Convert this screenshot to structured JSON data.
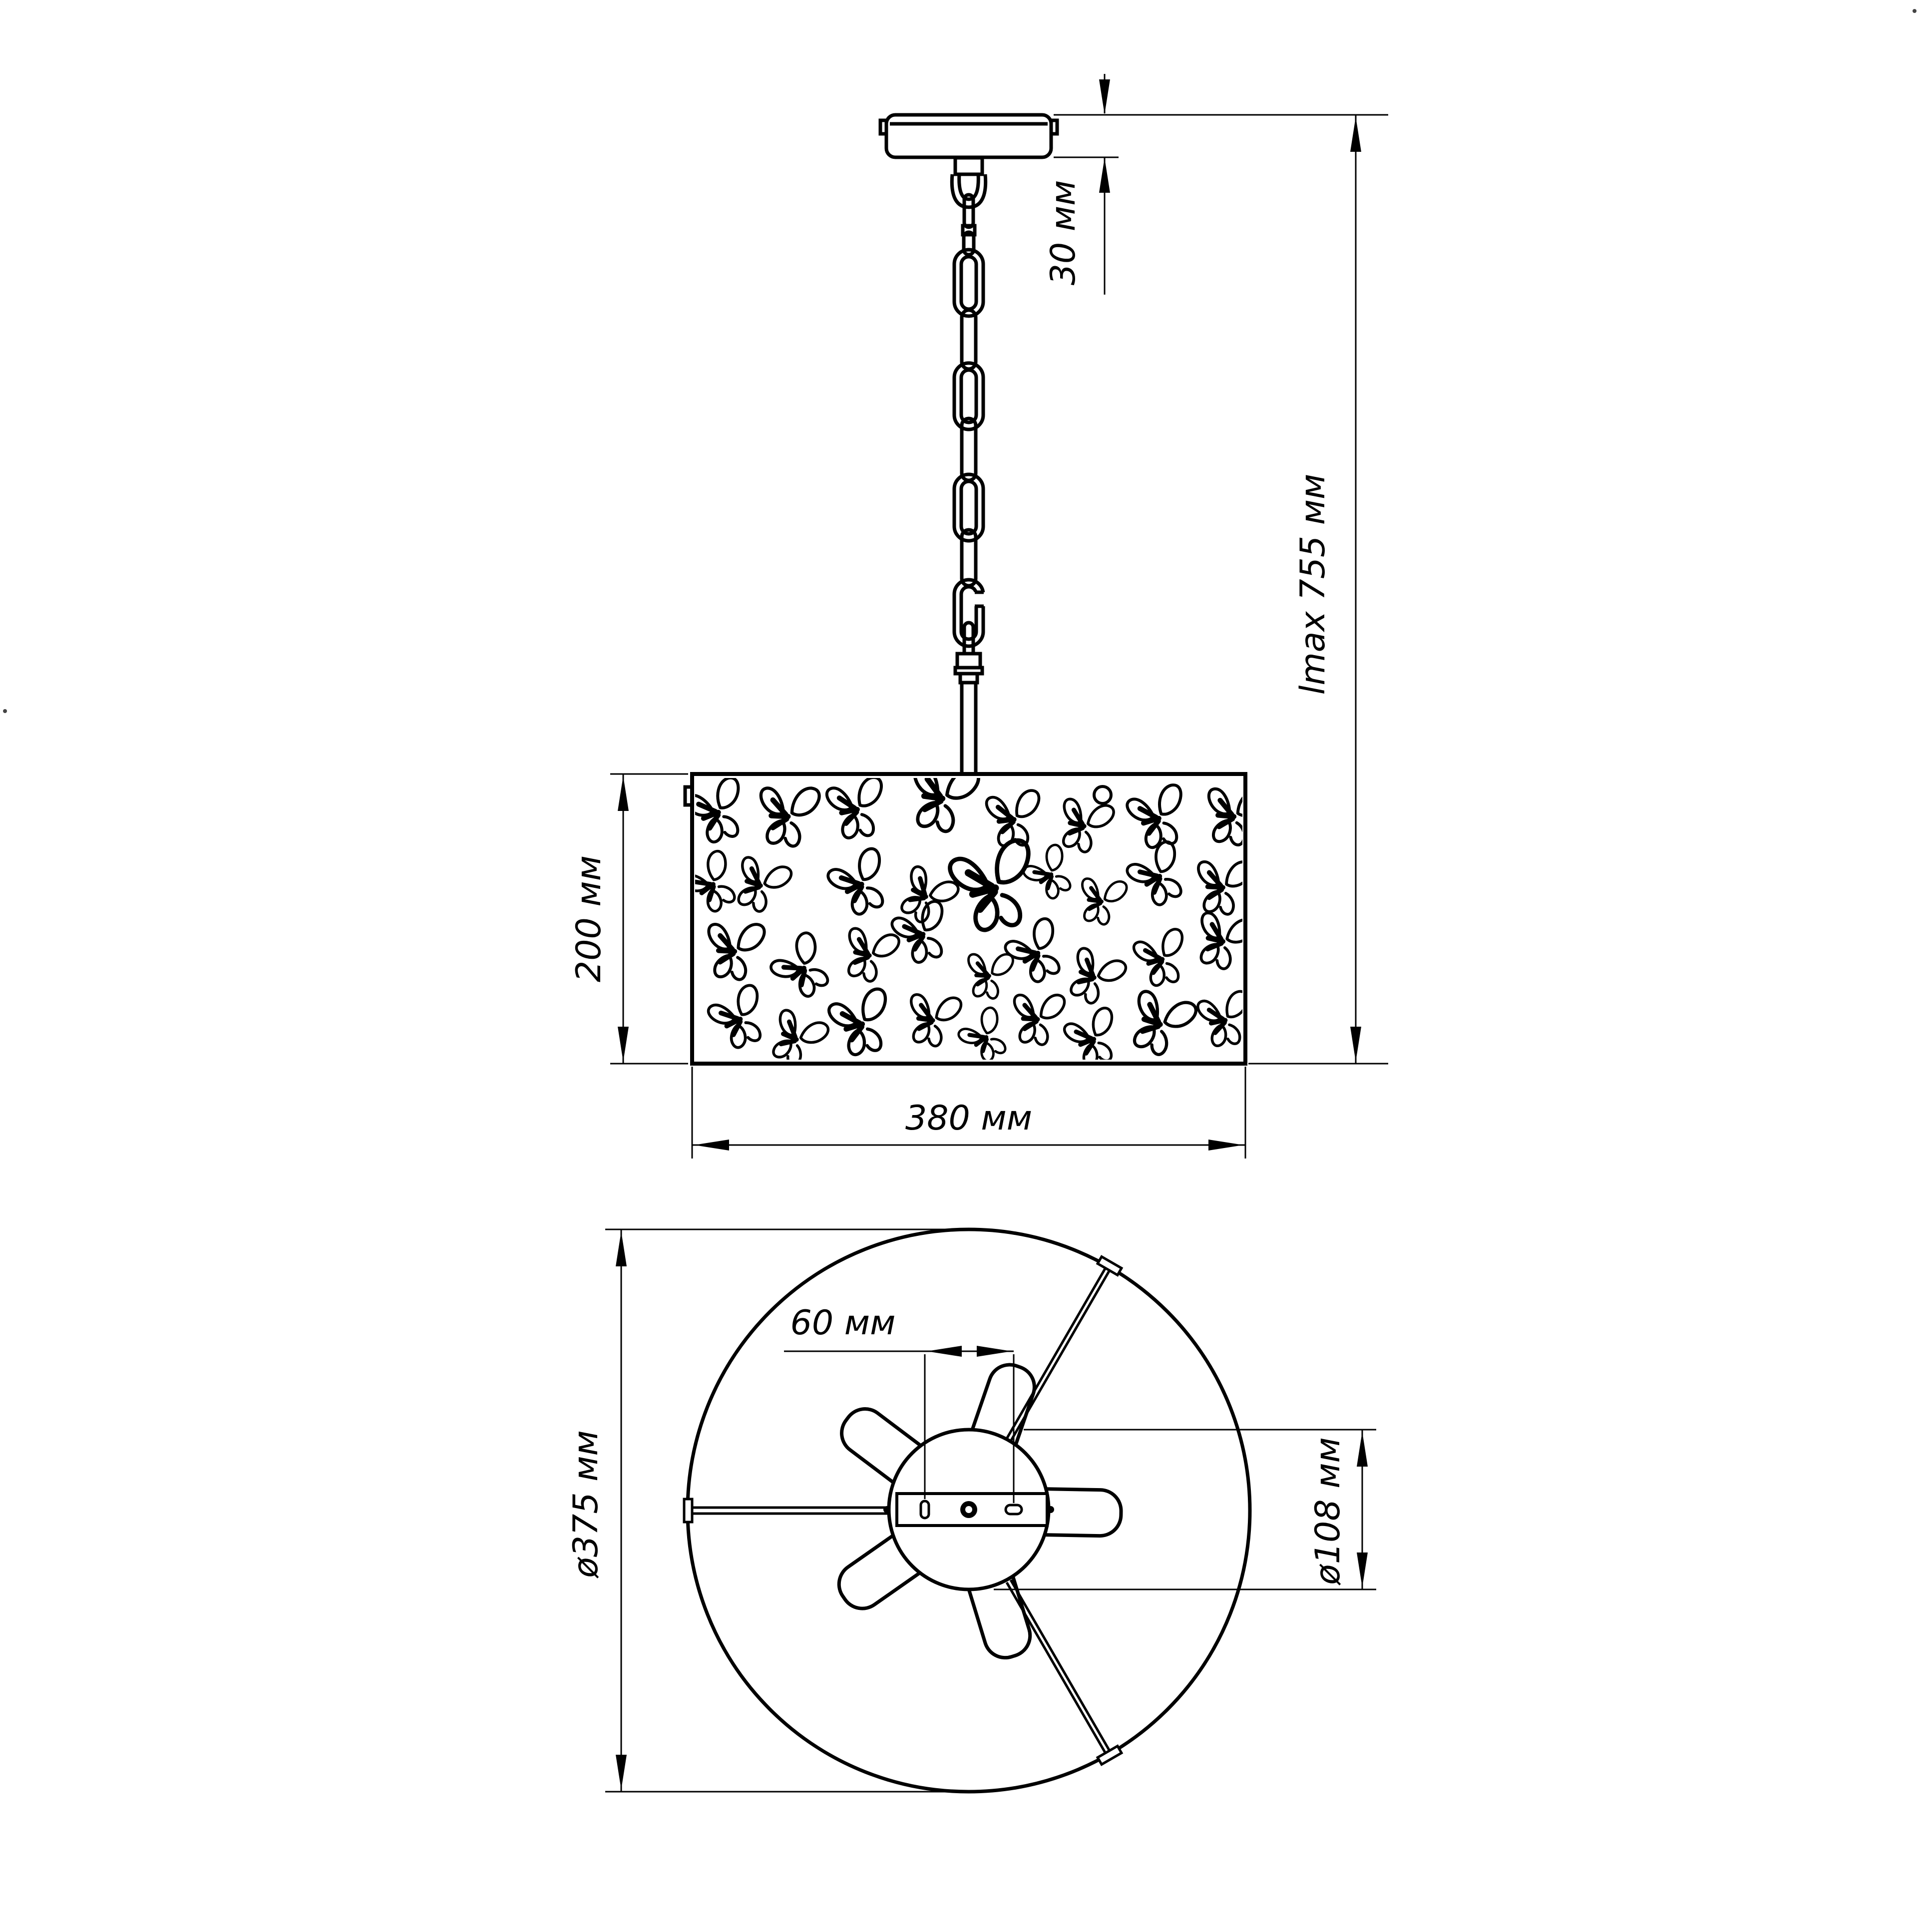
{
  "colors": {
    "background": "#ffffff",
    "ink": "#000000"
  },
  "side_view": {
    "dimensions": {
      "canopy_height": "30 мм",
      "max_length": "lmax 755 мм",
      "shade_height": "200 мм",
      "shade_width": "380 мм"
    }
  },
  "bottom_view": {
    "dimensions": {
      "socket_offset": "60 мм",
      "outer_diameter": "ø375 мм",
      "hub_diameter": "ø108 мм"
    }
  }
}
